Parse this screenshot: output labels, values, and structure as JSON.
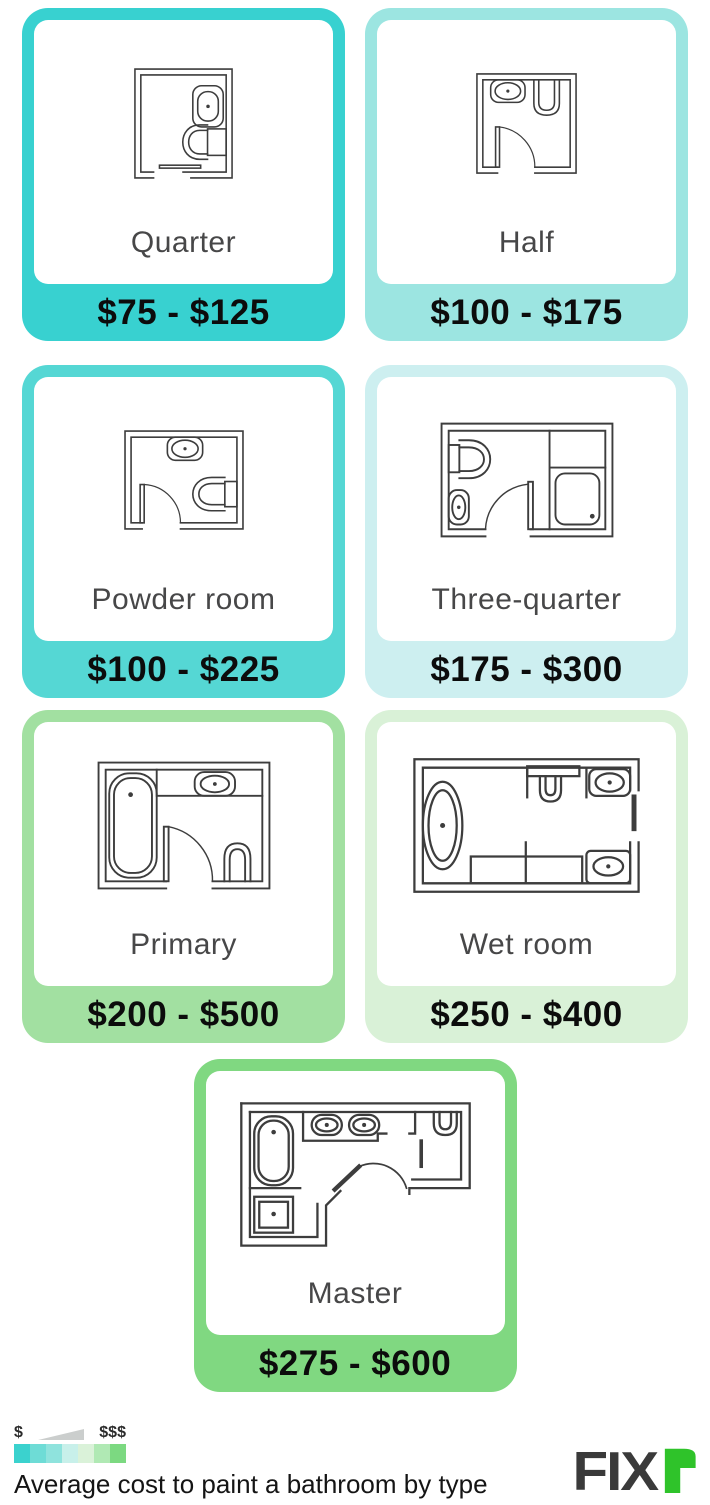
{
  "title": "Average cost to paint a bathroom by type",
  "cards": [
    {
      "label": "Quarter",
      "price": "$75 - $125",
      "color": "#38d1d0",
      "icon": "quarter-floorplan-icon"
    },
    {
      "label": "Half",
      "price": "$100 - $175",
      "color": "#9ce5e1",
      "icon": "half-floorplan-icon"
    },
    {
      "label": "Powder room",
      "price": "$100 - $225",
      "color": "#55d7d4",
      "icon": "powder-room-floorplan-icon"
    },
    {
      "label": "Three-quarter",
      "price": "$175 - $300",
      "color": "#cdeff0",
      "icon": "three-quarter-floorplan-icon"
    },
    {
      "label": "Primary",
      "price": "$200 - $500",
      "color": "#a2e0a1",
      "icon": "primary-floorplan-icon"
    },
    {
      "label": "Wet room",
      "price": "$250 - $400",
      "color": "#d9f1d7",
      "icon": "wet-room-floorplan-icon"
    },
    {
      "label": "Master",
      "price": "$275 - $600",
      "color": "#80d881",
      "icon": "master-floorplan-icon"
    }
  ],
  "legend": {
    "low_label": "$",
    "high_label": "$$$",
    "wedge_color": "#cbcecd",
    "swatches": [
      "#3bd2ce",
      "#6edcd6",
      "#8fe3dd",
      "#c8f0ea",
      "#daf2d9",
      "#b0e9b4",
      "#7cd981"
    ]
  },
  "caption": "Average cost to paint a bathroom by type",
  "logo": {
    "text": "FIX",
    "r_glyph": "r",
    "text_color": "#3a3a3a",
    "accent_color": "#2fc32a"
  },
  "chart_data": {
    "type": "table",
    "title": "Average cost to paint a bathroom by type",
    "categories": [
      "Quarter",
      "Half",
      "Powder room",
      "Three-quarter",
      "Primary",
      "Wet room",
      "Master"
    ],
    "series": [
      {
        "name": "Cost low ($)",
        "values": [
          75,
          100,
          100,
          175,
          200,
          250,
          275
        ]
      },
      {
        "name": "Cost high ($)",
        "values": [
          125,
          175,
          225,
          300,
          500,
          400,
          600
        ]
      }
    ],
    "ranges": [
      "$75 - $125",
      "$100 - $175",
      "$100 - $225",
      "$175 - $300",
      "$200 - $500",
      "$250 - $400",
      "$275 - $600"
    ],
    "legend_note": "color scale from $ (teal) to $$$ (green)"
  }
}
